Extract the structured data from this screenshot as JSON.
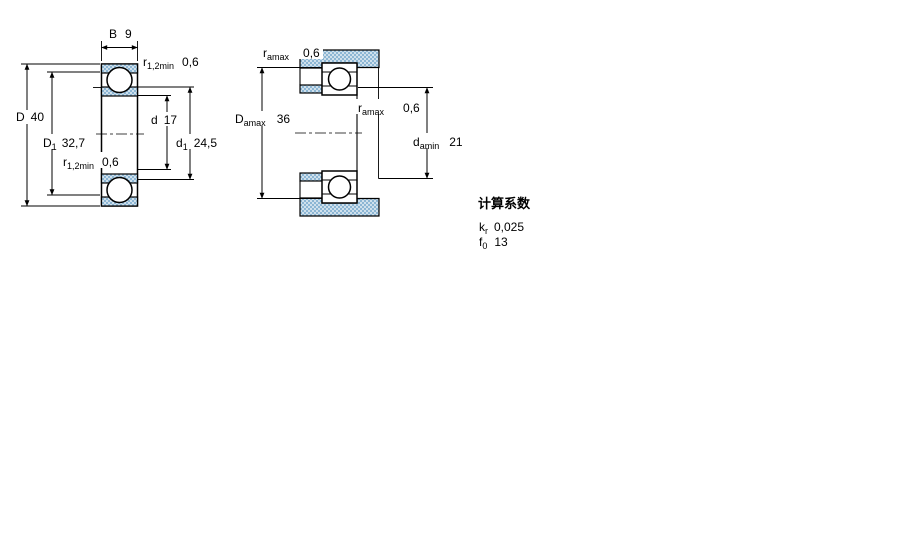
{
  "figure_left": {
    "dim_B": {
      "base": "B",
      "value": "9"
    },
    "r_top": {
      "base": "r",
      "sub": "1,2min",
      "value": "0,6"
    },
    "dim_D": {
      "base": "D",
      "value": "40"
    },
    "dim_D1": {
      "base": "D",
      "sub": "1",
      "value": "32,7"
    },
    "r_bottom": {
      "base": "r",
      "sub": "1,2min",
      "value": "0,6"
    },
    "dim_d": {
      "base": "d",
      "value": "17"
    },
    "dim_d1": {
      "base": "d",
      "sub": "1",
      "value": "24,5"
    }
  },
  "figure_right": {
    "r_amax_top": {
      "base": "r",
      "sub": "amax",
      "value": "0,6"
    },
    "dim_D_amax": {
      "base": "D",
      "sub": "amax",
      "value": "36"
    },
    "r_amax_mid": {
      "base": "r",
      "sub": "amax",
      "value": "0,6"
    },
    "dim_d_amin": {
      "base": "d",
      "sub": "amin",
      "value": "21"
    }
  },
  "calculation_factors": {
    "heading": "计算系数",
    "rows": [
      {
        "base": "k",
        "sub": "r",
        "value": "0,025"
      },
      {
        "base": "f",
        "sub": "0",
        "value": "13"
      }
    ]
  },
  "colors": {
    "hatch_dot": "#8cb6d4",
    "hatch_bg": "#cfe0ec",
    "line": "#000000"
  }
}
